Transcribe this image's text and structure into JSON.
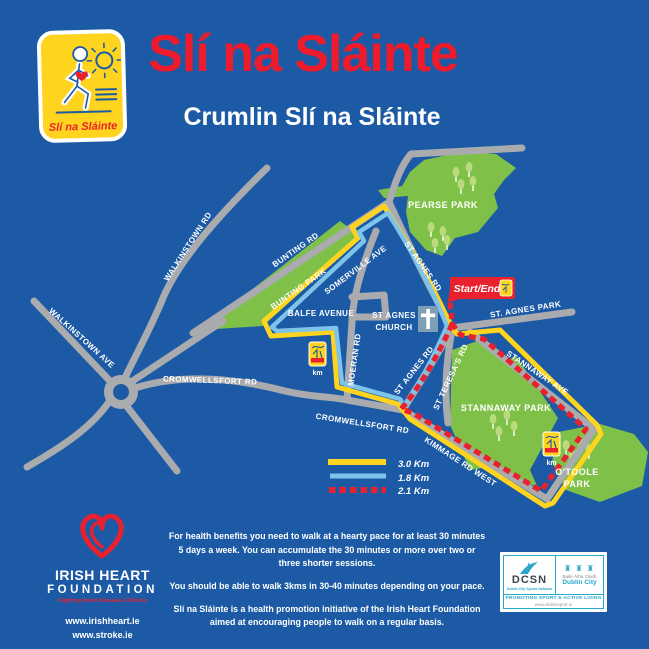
{
  "header": {
    "title": "Slí na Sláinte",
    "subtitle": "Crumlin Slí na Sláinte",
    "logo_script": "Slí na Sláinte"
  },
  "map": {
    "labels": {
      "walkinstown_rd": "WALKINSTOWN RD",
      "walkinstown_ave": "WALKINSTOWN AVE",
      "bunting_rd": "BUNTING RD",
      "bunting_park": "BUNTING PARK",
      "somerville_ave": "SOMERVILLE AVE",
      "balfe_avenue": "BALFE AVENUE",
      "moeran_rd": "MOERAN RD",
      "st_agnes_rd": "ST AGNES RD",
      "st_agnes_church_line1": "ST AGNES",
      "st_agnes_church_line2": "CHURCH",
      "pearse_park": "PEARSE PARK",
      "st_agnes_park": "ST. AGNES PARK",
      "st_teresas_rd": "ST TERESA'S RD",
      "stannaway_ave": "STANNAWAY AVE",
      "stannaway_park": "STANNAWAY PARK",
      "otoole_park_line1": "O'TOOLE",
      "otoole_park_line2": "PARK",
      "cromwellsfort_rd": "CROMWELLSFORT RD",
      "kimmage_rd_west": "KIMMAGE RD WEST"
    },
    "start_end_label": "Start/End",
    "km_marker_label": "km",
    "legend": [
      {
        "label": "3.0 Km",
        "style": "solid",
        "color": "#FFD41E"
      },
      {
        "label": "1.8 Km",
        "style": "solid",
        "color": "#7EC4EA"
      },
      {
        "label": "2.1 Km",
        "style": "dashed",
        "color": "#E9212E"
      }
    ]
  },
  "footer": {
    "ihf": {
      "name_line1": "IRISH HEART",
      "name_line2": "FOUNDATION",
      "tagline": "Fighting Heart Disease & Stroke",
      "url1": "www.irishheart.ie",
      "url2": "www.stroke.ie"
    },
    "paragraphs": [
      "For health benefits you need to walk at a hearty pace for at least 30 minutes 5 days a week. You can accumulate the 30 minutes or more over two or three shorter sessions.",
      "You should be able to walk 3kms in 30-40 minutes depending on your pace.",
      "Slí na Sláinte is a health promotion initiative of the Irish Heart Foundation aimed at encouraging people to walk on a regular basis."
    ],
    "dcsn": {
      "name": "DCSN",
      "caption": "Dublin City Sports Network",
      "irish_name": "Baile Átha Cliath",
      "city_name": "Dublin City",
      "castles_icon": "♜ ♜ ♜",
      "promo": "PROMOTING SPORT & ACTIVE LIVING",
      "url": "www.dublinsport.ie"
    }
  },
  "colors": {
    "background": "#1C5AA5",
    "red": "#E9212E",
    "title_red": "#ED1B2C",
    "yellow": "#FFD41E",
    "park_green": "#7FC148",
    "tree_green": "#B9DB7E",
    "road_gray": "#A9ABAE",
    "route_blue": "#7EC4EA",
    "church_slate": "#7E9FB5",
    "teal": "#29A8CC"
  }
}
